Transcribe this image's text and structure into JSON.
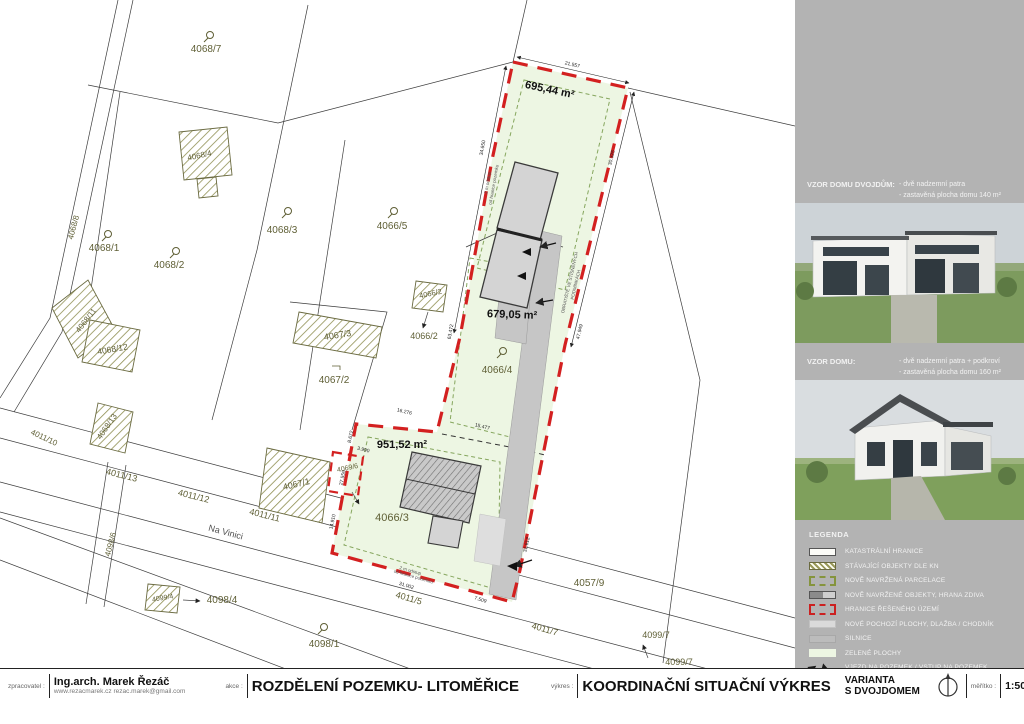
{
  "title_block": {
    "zpracovatel_label": "zpracovatel :",
    "author": "Ing.arch. Marek Řezáč",
    "author_contact": "www.rezacmarek.cz  rezac.marek@gmail.com",
    "akce_label": "akce :",
    "akce": "ROZDĚLENÍ POZEMKU-  LITOMĚŘICE",
    "vykres_label": "výkres :",
    "vykres": "KOORDINAČNÍ SITUAČNÍ VÝKRES",
    "varianta_line1": "VARIANTA",
    "varianta_line2": "S DVOJDOMEM",
    "meritko_label": "měřítko :",
    "meritko": "1:500",
    "datum_label": "datum :",
    "datum": "21/10/2025"
  },
  "sidebar": {
    "panel_color": "#b3b3b3",
    "house1": {
      "title": "VZOR DOMU DVOJDŮM:",
      "line1": "- dvě nadzemní patra",
      "line2": "- zastavěná plocha domu 140 m²"
    },
    "house2": {
      "title": "VZOR DOMU:",
      "line1": "- dvě nadzemní patra + podkroví",
      "line2": "- zastavěná plocha domu 160 m²"
    },
    "legend": {
      "title": "LEGENDA",
      "items": [
        {
          "key": "katastr",
          "label": "KATASTRÁLNÍ HRANICE"
        },
        {
          "key": "stavajici",
          "label": "STÁVAJÍCÍ OBJEKTY DLE KN"
        },
        {
          "key": "parcelace",
          "label": "NOVĚ NAVRŽENÁ PARCELACE"
        },
        {
          "key": "objekty",
          "label": "NOVĚ NAVRŽENÉ OBJEKTY, HRANA ZDIVA"
        },
        {
          "key": "hranice",
          "label": "HRANICE ŘEŠENÉHO ÚZEMÍ"
        },
        {
          "key": "pochozi",
          "label": "NOVÉ POCHOZÍ PLOCHY, DLAŽBA / CHODNÍK"
        },
        {
          "key": "silnice",
          "label": "SILNICE"
        },
        {
          "key": "zelene",
          "label": "ZELENÉ PLOCHY"
        },
        {
          "key": "vjezd",
          "label": "VJEZD NA POZEMEK / VSTUP NA POZEMEK"
        }
      ]
    }
  },
  "plan": {
    "colors": {
      "site_green": "#edf6e3",
      "boundary_red": "#d32020",
      "road_gray": "#c6c6c6",
      "parcel_label": "#5f5f35"
    },
    "street_name": "Na Vinici",
    "areas": [
      "695,44 m²",
      "679,05 m²",
      "951,52 m²"
    ],
    "labels": [
      {
        "t": "695,44 m²",
        "x": 549,
        "y": 93,
        "r": 12,
        "s": 11,
        "c": "a"
      },
      {
        "t": "679,05 m²",
        "x": 512,
        "y": 318,
        "r": 2,
        "s": 11,
        "c": "a"
      },
      {
        "t": "951,52 m²",
        "x": 402,
        "y": 448,
        "r": 0,
        "s": 11,
        "c": "a"
      },
      {
        "t": "21.557",
        "x": 572,
        "y": 66,
        "r": 13,
        "s": 5,
        "c": "d"
      },
      {
        "t": "34.650",
        "x": 484,
        "y": 148,
        "r": -80,
        "s": 5,
        "c": "d"
      },
      {
        "t": "30.325",
        "x": 613,
        "y": 158,
        "r": -77,
        "s": 5,
        "c": "d"
      },
      {
        "t": "63.472",
        "x": 452,
        "y": 332,
        "r": -80,
        "s": 5,
        "c": "d"
      },
      {
        "t": "47.949",
        "x": 581,
        "y": 332,
        "r": -77,
        "s": 5,
        "c": "d"
      },
      {
        "t": "16.276",
        "x": 404,
        "y": 413,
        "r": 14,
        "s": 5,
        "c": "d"
      },
      {
        "t": "15.477",
        "x": 482,
        "y": 428,
        "r": 14,
        "s": 5,
        "c": "d"
      },
      {
        "t": "8.672",
        "x": 352,
        "y": 437,
        "r": -78,
        "s": 5,
        "c": "d"
      },
      {
        "t": "3.990",
        "x": 363,
        "y": 451,
        "r": 14,
        "s": 5,
        "c": "d"
      },
      {
        "t": "27.559",
        "x": 344,
        "y": 478,
        "r": -78,
        "s": 5,
        "c": "d"
      },
      {
        "t": "14.910",
        "x": 334,
        "y": 522,
        "r": -78,
        "s": 5,
        "c": "d"
      },
      {
        "t": "31.002",
        "x": 406,
        "y": 587,
        "r": 17,
        "s": 5,
        "c": "d"
      },
      {
        "t": "7.509",
        "x": 480,
        "y": 601,
        "r": 17,
        "s": 5,
        "c": "d"
      },
      {
        "t": "31.612",
        "x": 528,
        "y": 545,
        "r": -77,
        "s": 5,
        "c": "d"
      },
      {
        "t": "4068/7",
        "x": 206,
        "y": 52,
        "r": 0,
        "s": 10,
        "c": "p"
      },
      {
        "t": "4068/4",
        "x": 200,
        "y": 158,
        "r": -12,
        "s": 8,
        "c": "p"
      },
      {
        "t": "4068/1",
        "x": 104,
        "y": 251,
        "r": 0,
        "s": 10,
        "c": "p"
      },
      {
        "t": "4068/2",
        "x": 169,
        "y": 268,
        "r": 0,
        "s": 10,
        "c": "p"
      },
      {
        "t": "4068/3",
        "x": 282,
        "y": 233,
        "r": 0,
        "s": 10,
        "c": "p"
      },
      {
        "t": "4066/5",
        "x": 392,
        "y": 229,
        "r": 0,
        "s": 10,
        "c": "p"
      },
      {
        "t": "4068/8",
        "x": 76,
        "y": 228,
        "r": -75,
        "s": 8,
        "c": "p"
      },
      {
        "t": "4068/11",
        "x": 88,
        "y": 322,
        "r": -52,
        "s": 8,
        "c": "p"
      },
      {
        "t": "4068/12",
        "x": 113,
        "y": 352,
        "r": -10,
        "s": 8.5,
        "c": "p"
      },
      {
        "t": "4068/13",
        "x": 109,
        "y": 428,
        "r": -55,
        "s": 8,
        "c": "p"
      },
      {
        "t": "4067/3",
        "x": 338,
        "y": 338,
        "r": -9,
        "s": 9,
        "c": "p"
      },
      {
        "t": "4067/2",
        "x": 334,
        "y": 383,
        "r": 0,
        "s": 10,
        "c": "p"
      },
      {
        "t": "4067/1",
        "x": 297,
        "y": 487,
        "r": -13,
        "s": 9,
        "c": "p"
      },
      {
        "t": "4066/2",
        "x": 431,
        "y": 296,
        "r": -12,
        "s": 7.5,
        "c": "p"
      },
      {
        "t": "4066/2",
        "x": 424,
        "y": 339,
        "r": 0,
        "s": 9,
        "c": "p"
      },
      {
        "t": "4066/4",
        "x": 497,
        "y": 373,
        "r": 0,
        "s": 10,
        "c": "p"
      },
      {
        "t": "4066/3",
        "x": 392,
        "y": 521,
        "r": 0,
        "s": 11,
        "c": "p"
      },
      {
        "t": "4069/6",
        "x": 348,
        "y": 470,
        "r": -12,
        "s": 7,
        "c": "p"
      },
      {
        "t": "4099/4",
        "x": 163,
        "y": 600,
        "r": -10,
        "s": 7,
        "c": "p"
      },
      {
        "t": "4098/4",
        "x": 222,
        "y": 603,
        "r": 0,
        "s": 10,
        "c": "p"
      },
      {
        "t": "4098/1",
        "x": 324,
        "y": 647,
        "r": 0,
        "s": 10,
        "c": "p"
      },
      {
        "t": "4057/9",
        "x": 589,
        "y": 586,
        "r": 0,
        "s": 10,
        "c": "p"
      },
      {
        "t": "4099/7",
        "x": 656,
        "y": 638,
        "r": 0,
        "s": 9,
        "c": "p"
      },
      {
        "t": "4099/7",
        "x": 679,
        "y": 665,
        "r": 0,
        "s": 9,
        "c": "p"
      },
      {
        "t": "4098/6",
        "x": 113,
        "y": 545,
        "r": -75,
        "s": 8,
        "c": "p"
      },
      {
        "t": "4011/10",
        "x": 43,
        "y": 440,
        "r": 25,
        "s": 8,
        "c": "p"
      },
      {
        "t": "4011/13",
        "x": 121,
        "y": 478,
        "r": 14,
        "s": 9,
        "c": "p"
      },
      {
        "t": "4011/12",
        "x": 193,
        "y": 499,
        "r": 14,
        "s": 9,
        "c": "p"
      },
      {
        "t": "4011/11",
        "x": 264,
        "y": 518,
        "r": 14,
        "s": 9,
        "c": "p"
      },
      {
        "t": "Na Vinici",
        "x": 225,
        "y": 535,
        "r": 15,
        "s": 9,
        "c": "s"
      },
      {
        "t": "4011/5",
        "x": 408,
        "y": 601,
        "r": 16,
        "s": 9,
        "c": "p"
      },
      {
        "t": "4011/7",
        "x": 544,
        "y": 632,
        "r": 16,
        "s": 9,
        "c": "p"
      },
      {
        "t": "2 m odstup",
        "x": 489,
        "y": 183,
        "r": -80,
        "s": 4.5,
        "c": "n"
      },
      {
        "t": "od hranice pozemku",
        "x": 495,
        "y": 185,
        "r": -80,
        "s": 4.5,
        "c": "n"
      },
      {
        "t": "2 m odstup",
        "x": 410,
        "y": 572,
        "r": 16,
        "s": 4.5,
        "c": "n"
      },
      {
        "t": "od hranice pozemku",
        "x": 413,
        "y": 578,
        "r": 16,
        "s": 4.5,
        "c": "n"
      },
      {
        "t": "OBRATIŠTĚ VE STÍSNĚNÝCH",
        "x": 571,
        "y": 283,
        "r": -77,
        "s": 4.5,
        "c": "n"
      },
      {
        "t": "PODMÍNKÁCH",
        "x": 577,
        "y": 285,
        "r": -77,
        "s": 4.5,
        "c": "n"
      }
    ]
  }
}
